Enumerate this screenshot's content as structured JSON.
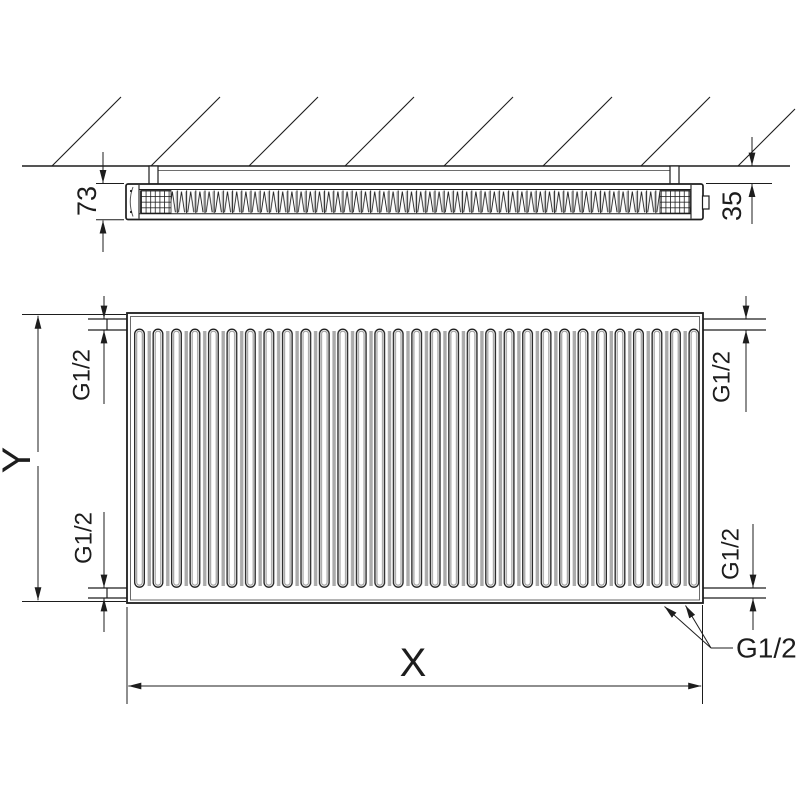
{
  "drawing": {
    "labels": {
      "depth": "73",
      "wall_distance": "35",
      "height": "Y",
      "width": "X",
      "thread": "G1/2"
    },
    "colors": {
      "line": "#1d1d1d",
      "shade": "#9b9b9b"
    }
  }
}
